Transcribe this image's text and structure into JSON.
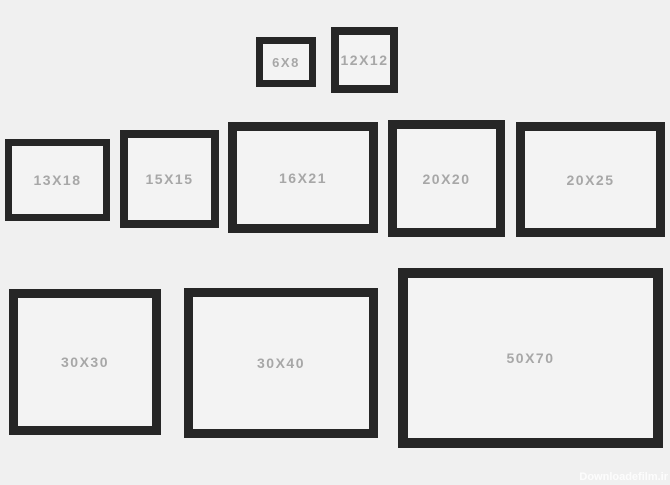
{
  "frames": [
    {
      "label": "6X8"
    },
    {
      "label": "12X12"
    },
    {
      "label": "13X18"
    },
    {
      "label": "15X15"
    },
    {
      "label": "16X21"
    },
    {
      "label": "20X20"
    },
    {
      "label": "20X25"
    },
    {
      "label": "30X30"
    },
    {
      "label": "30X40"
    },
    {
      "label": "50X70"
    }
  ],
  "watermark": {
    "text": "Downloadefilm.ir"
  },
  "colors": {
    "background": "#f0f0f0",
    "frame_border": "#262626",
    "frame_inner": "#f3f3f3",
    "label_text": "#a7a7a7",
    "watermark_text": "#ffffff"
  }
}
